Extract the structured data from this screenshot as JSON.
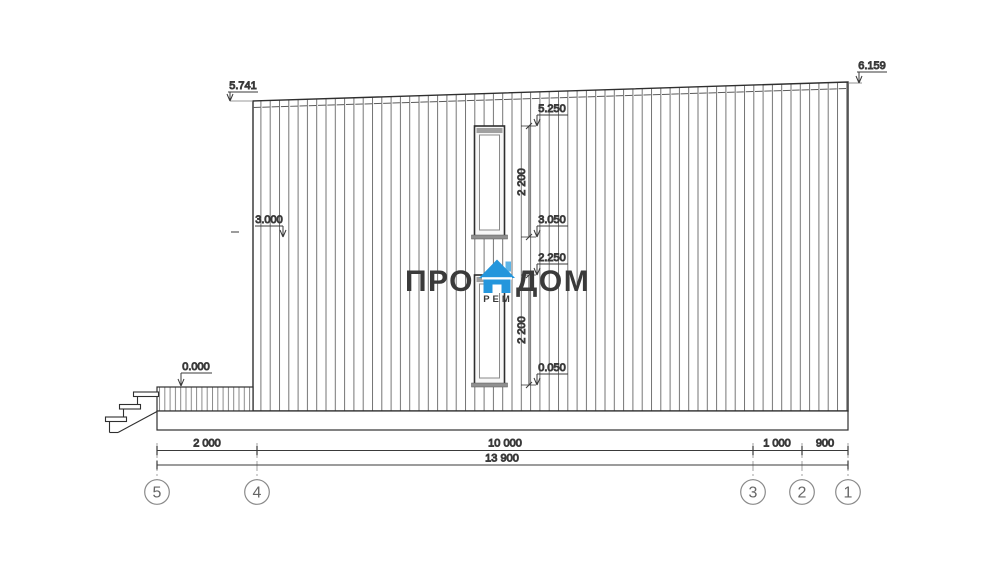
{
  "watermark": {
    "part1": "ПРО",
    "part2": "ДОМ",
    "sub": "РЕМ"
  },
  "elevations": {
    "roof_left": "5.741",
    "roof_right": "6.159",
    "second_floor": "3.000",
    "porch": "0.000",
    "upper_window_top": "5.250",
    "upper_window_height": "2 200",
    "upper_window_bottom": "3.050",
    "lower_window_top": "2.250",
    "lower_window_height": "2 200",
    "lower_window_bottom": "0.050"
  },
  "dimensions": {
    "span_5_4": "2 000",
    "span_4_3": "10 000",
    "span_3_2": "1 000",
    "span_2_1": "900",
    "total": "13 900"
  },
  "axes": [
    {
      "label": "5"
    },
    {
      "label": "4"
    },
    {
      "label": "3"
    },
    {
      "label": "2"
    },
    {
      "label": "1"
    }
  ],
  "colors": {
    "accent_blue": "#2496dc",
    "accent_blue_light": "#5cb5e8",
    "logo_text": "#3b3b3d",
    "line": "#2f2f2f"
  }
}
